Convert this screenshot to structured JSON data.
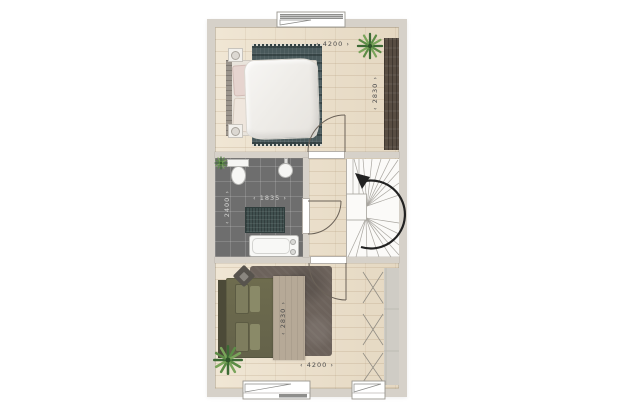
{
  "dimensions": {
    "bedroom_top": {
      "width": "4200",
      "depth": "2830"
    },
    "bathroom": {
      "width": "1835",
      "depth": "2400"
    },
    "bedroom_bottom": {
      "width": "4200",
      "depth": "2830"
    }
  },
  "colors": {
    "background": "#ffffff",
    "wall": "#d6d1c9",
    "wood_floor": "#ecdfc8",
    "bathroom_tile": "#6e6e6e",
    "rug_top": "#49595b",
    "rug_bottom": "#6c625b",
    "bed_bottom_duvet": "#6a684b",
    "blanket": "#b6a997",
    "wardrobe_top": "#584d42",
    "wardrobe_bottom": "#cfccc5",
    "plant": "#4e7a40",
    "stairs": "#fbfaf8",
    "arrow": "#222222",
    "dimension_text_dark": "#4c4c4c",
    "dimension_text_light": "#d5d5d3"
  },
  "icons": [
    "double-bed-icon",
    "duvet-icon",
    "pillow-icon",
    "nightstand-icon",
    "lamp-icon",
    "rug-icon",
    "wardrobe-icon",
    "plant-icon",
    "toilet-icon",
    "washbasin-icon",
    "bathtub-icon",
    "shower-mat-icon",
    "staircase-icon",
    "stair-direction-arrow-icon",
    "window-icon",
    "door-swing-icon",
    "pouf-icon"
  ]
}
